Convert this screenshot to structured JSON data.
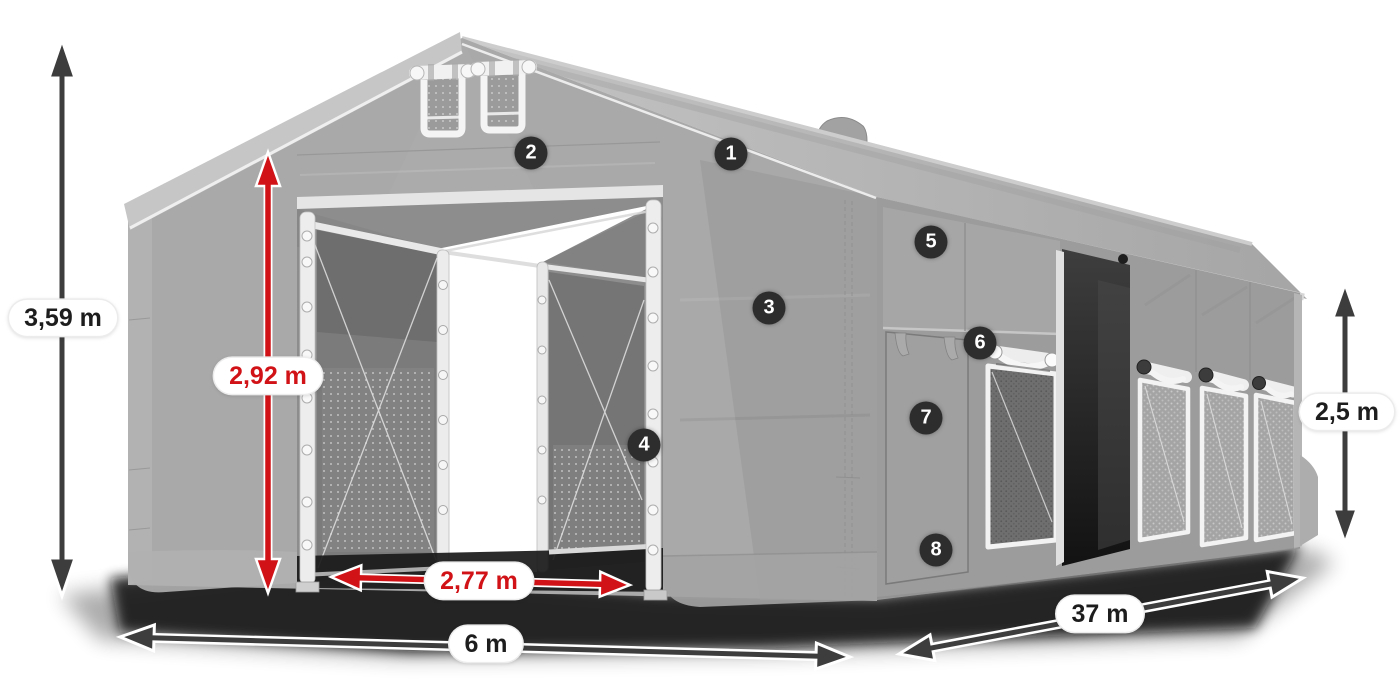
{
  "diagram": {
    "dimension_labels": {
      "total_height": "3,59 m",
      "entrance_height": "2,92 m",
      "entrance_width": "2,77 m",
      "width": "6 m",
      "length": "37 m",
      "side_height": "2,5 m"
    },
    "callouts": [
      {
        "number": "1"
      },
      {
        "number": "2"
      },
      {
        "number": "3"
      },
      {
        "number": "4"
      },
      {
        "number": "5"
      },
      {
        "number": "6"
      },
      {
        "number": "7"
      },
      {
        "number": "8"
      }
    ],
    "colors": {
      "highlight_red": "#d11317",
      "arrow_gray": "#3d3d3d",
      "badge_background": "#2d2d2d",
      "badge_text": "#ffffff",
      "label_background": "#ffffff",
      "label_text": "#1d1d1d",
      "tent_body_gray": "#a7a7a7",
      "roof_gray": "#bdbdbd",
      "interior_gray": "#7b7b7b",
      "frame_white": "#f2f2f2",
      "open_door_dark": "#1c1c1c"
    }
  }
}
